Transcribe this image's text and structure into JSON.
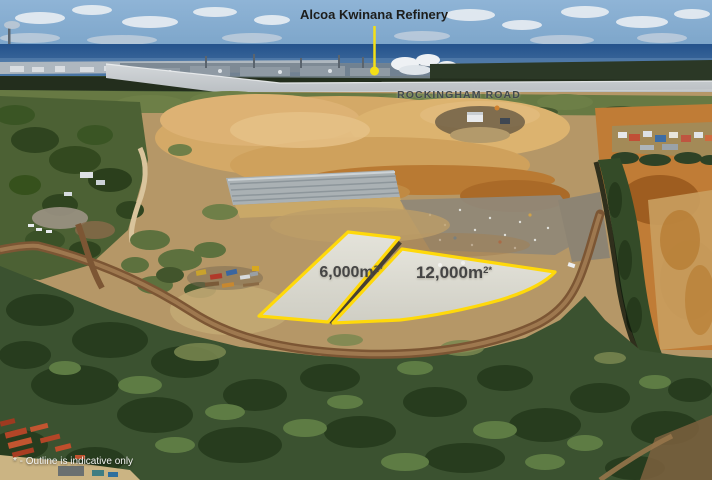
{
  "callout": {
    "label": "Alcoa Kwinana Refinery"
  },
  "road": {
    "label": "ROCKINGHAM ROAD"
  },
  "parcels": [
    {
      "id": "lot-6000",
      "area_value": "6,000m",
      "area_superscript": "2*"
    },
    {
      "id": "lot-12000",
      "area_value": "12,000m",
      "area_superscript": "2*"
    }
  ],
  "disclaimer": {
    "text": "* - Outline is indicative only"
  },
  "colors": {
    "accent_yellow": "#F4DF17",
    "outline_yellow": "#FFD90A",
    "callout_text": "#1d1d1b",
    "road_text": "#41484e",
    "parcel_text": "#454545",
    "disclaimer_text": "#f4f4f2"
  }
}
